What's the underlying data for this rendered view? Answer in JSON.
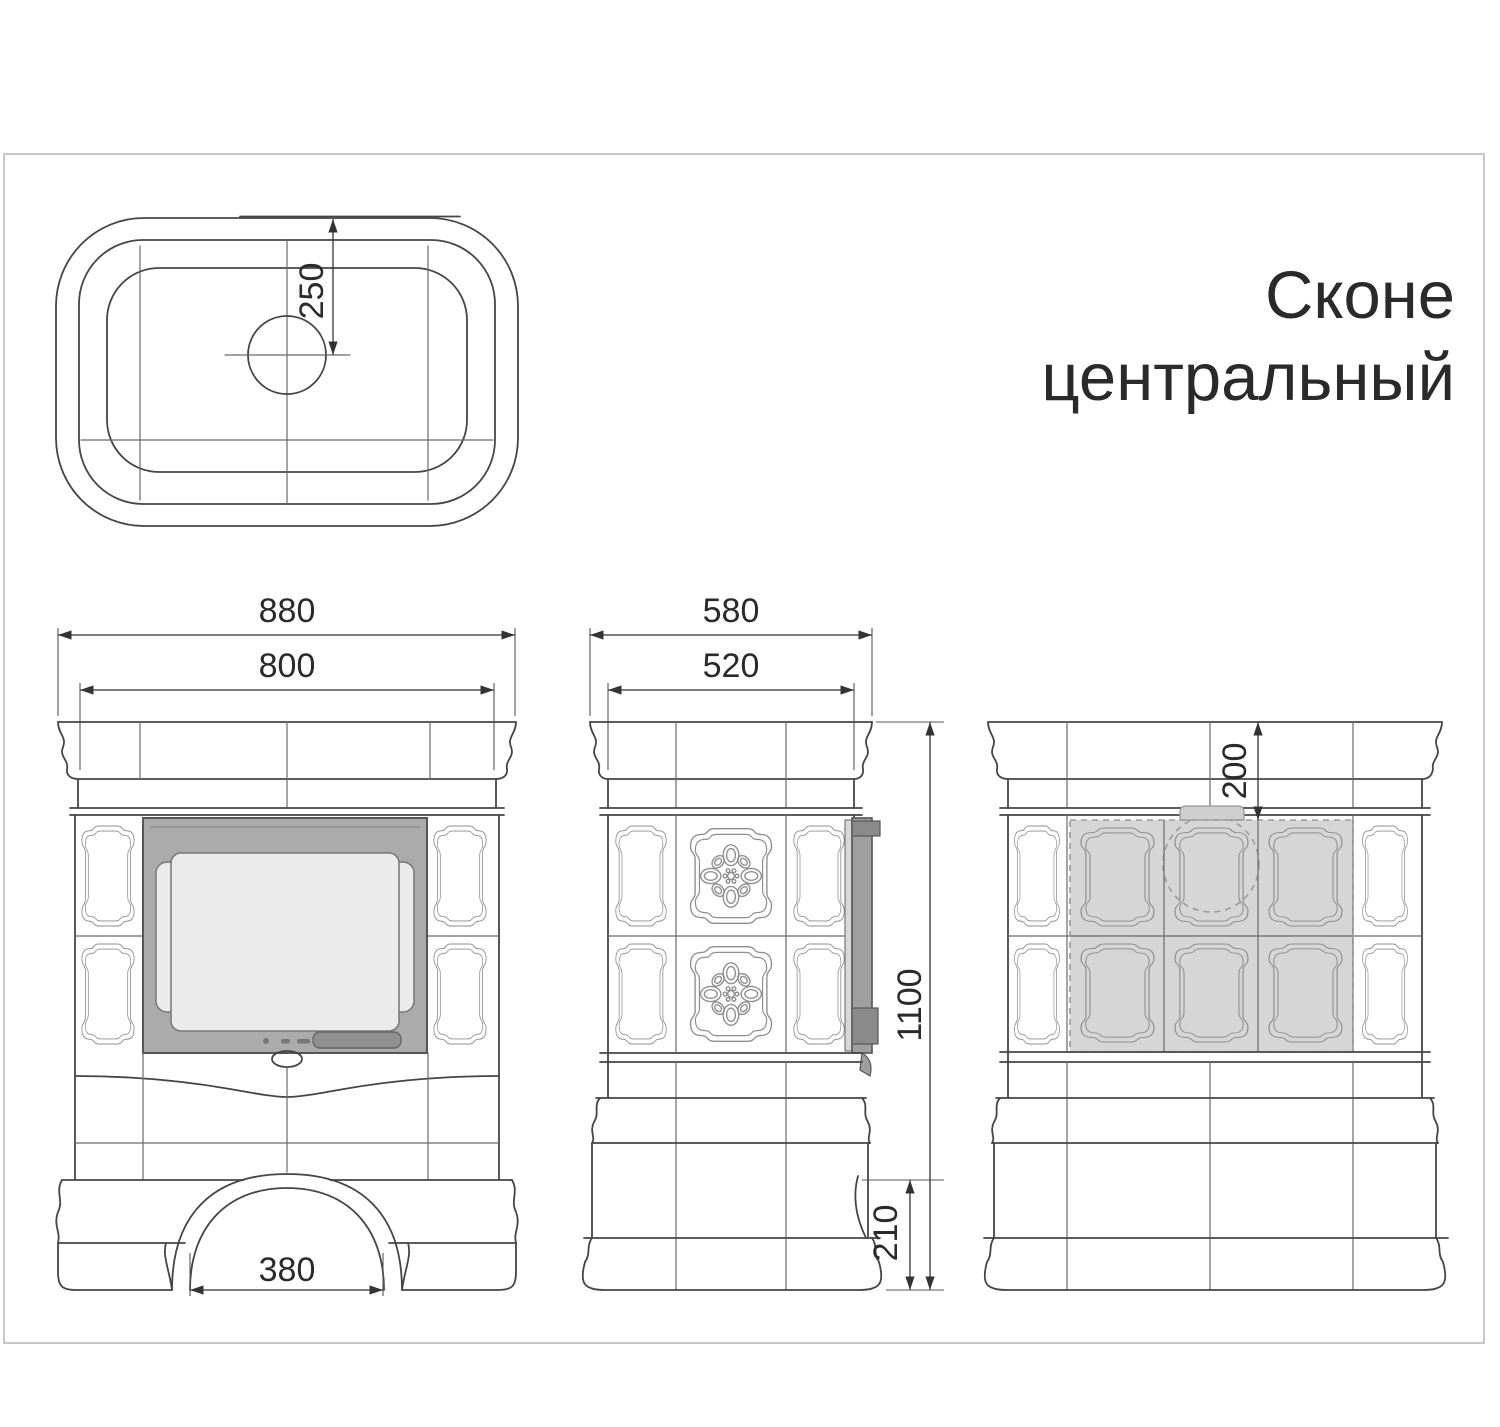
{
  "title": {
    "line1": "Сконе",
    "line2": "центральный"
  },
  "dimensions": {
    "top_flue_offset": "250",
    "front_cornice_width": "880",
    "front_body_width": "800",
    "front_arch_width": "380",
    "side_cornice_depth": "580",
    "side_body_depth": "520",
    "side_total_height": "1100",
    "side_arch_height": "210",
    "rear_flue_offset": "200"
  },
  "colors": {
    "line": "#454545",
    "dimension": "#333333",
    "door_frame": "#ababab",
    "door_glass": "#ebebeb",
    "door_handle": "#8f8f8f",
    "door_edge": "#9f9f9f",
    "shaded_tiles": "#d6d6d6",
    "chimney_tab": "#cfcfcf",
    "page_border": "#b3b3b3"
  }
}
